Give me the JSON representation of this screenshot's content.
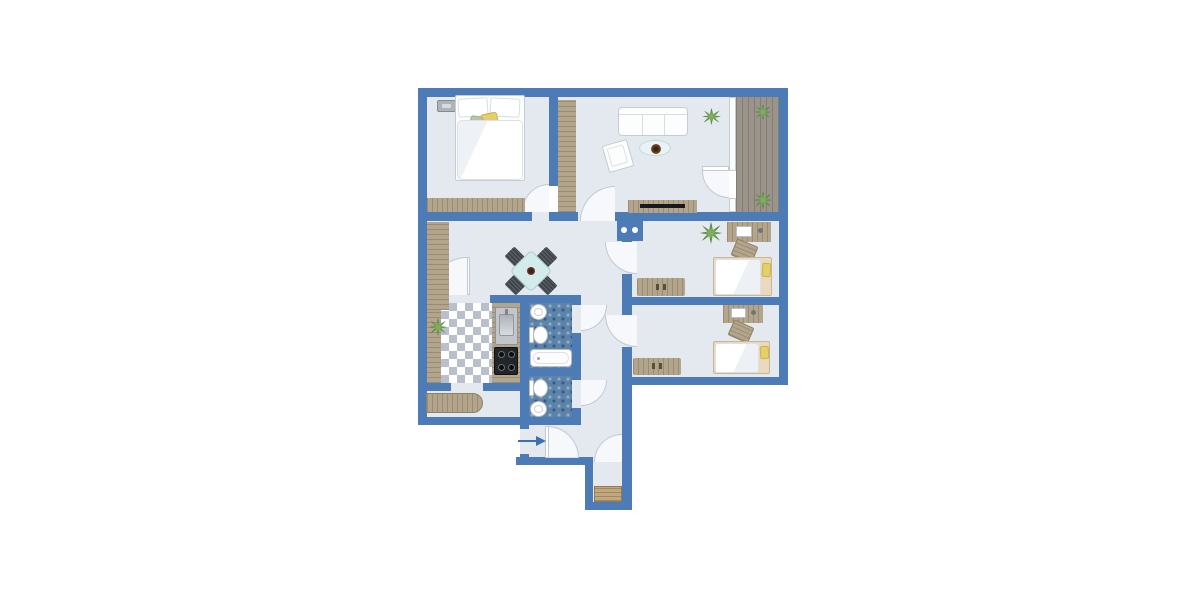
{
  "meta": {
    "kind": "apartment-floor-plan",
    "visible_text": "none"
  },
  "colors": {
    "wall": "#4c7bb5",
    "floor": "#e4e8ef",
    "wood": "#b3a58c",
    "grain": "rgba(115,99,76,.38)",
    "deck": "#9a948b",
    "deckline": "rgba(72,66,58,.28)",
    "mosaic": "#5d83a9",
    "mosaicLight": "#8fafc9",
    "mosaicDark": "#315c88",
    "checker": "#b9c0cb",
    "white": "#fcfdfd",
    "wborder": "#c6ccd4",
    "teal": "#d3ebeb",
    "tealBorder": "#a9cfd1",
    "chair": "#3e434a",
    "yellow": "#e5cf6b",
    "sage": "#b9c6a6",
    "plant1": "#7fae5d",
    "plant2": "#3f7330",
    "pot": "#7c4f27",
    "mat": "#c2a87e",
    "matline": "rgba(122,98,60,.45)",
    "tv": "#17191c",
    "arrow": "#3a72b0"
  },
  "plan": {
    "entry_arrow_direction": "right",
    "rooms": [
      {
        "name": "bedroom-top-left",
        "furniture": [
          "double-bed",
          "pillows",
          "dresser",
          "wall-picture"
        ]
      },
      {
        "name": "living-room",
        "furniture": [
          "sofa",
          "armchair",
          "coffee-table-with-plant",
          "tv-lowboard",
          "tall-wardrobe",
          "plant"
        ]
      },
      {
        "name": "balcony",
        "furniture": [
          "wood-decking",
          "plant",
          "plant"
        ]
      },
      {
        "name": "hall-dining",
        "furniture": [
          "square-table",
          "four-chairs",
          "wardrobe"
        ]
      },
      {
        "name": "kitchen",
        "furniture": [
          "counter-left",
          "counter-right",
          "sink",
          "stove",
          "plant",
          "checkered-floor"
        ]
      },
      {
        "name": "bathroom",
        "furniture": [
          "washbasin",
          "toilet",
          "bathtub"
        ]
      },
      {
        "name": "wc",
        "furniture": [
          "toilet",
          "washbasin"
        ]
      },
      {
        "name": "utility-room",
        "furniture": [
          "bench"
        ]
      },
      {
        "name": "bedroom-right-1",
        "furniture": [
          "desk",
          "desk-chair",
          "single-bed",
          "sideboard",
          "plant"
        ]
      },
      {
        "name": "bedroom-right-2",
        "furniture": [
          "desk",
          "desk-chair",
          "single-bed",
          "sideboard"
        ]
      },
      {
        "name": "entrance",
        "furniture": [
          "entry-arrow",
          "doormat"
        ]
      }
    ]
  }
}
